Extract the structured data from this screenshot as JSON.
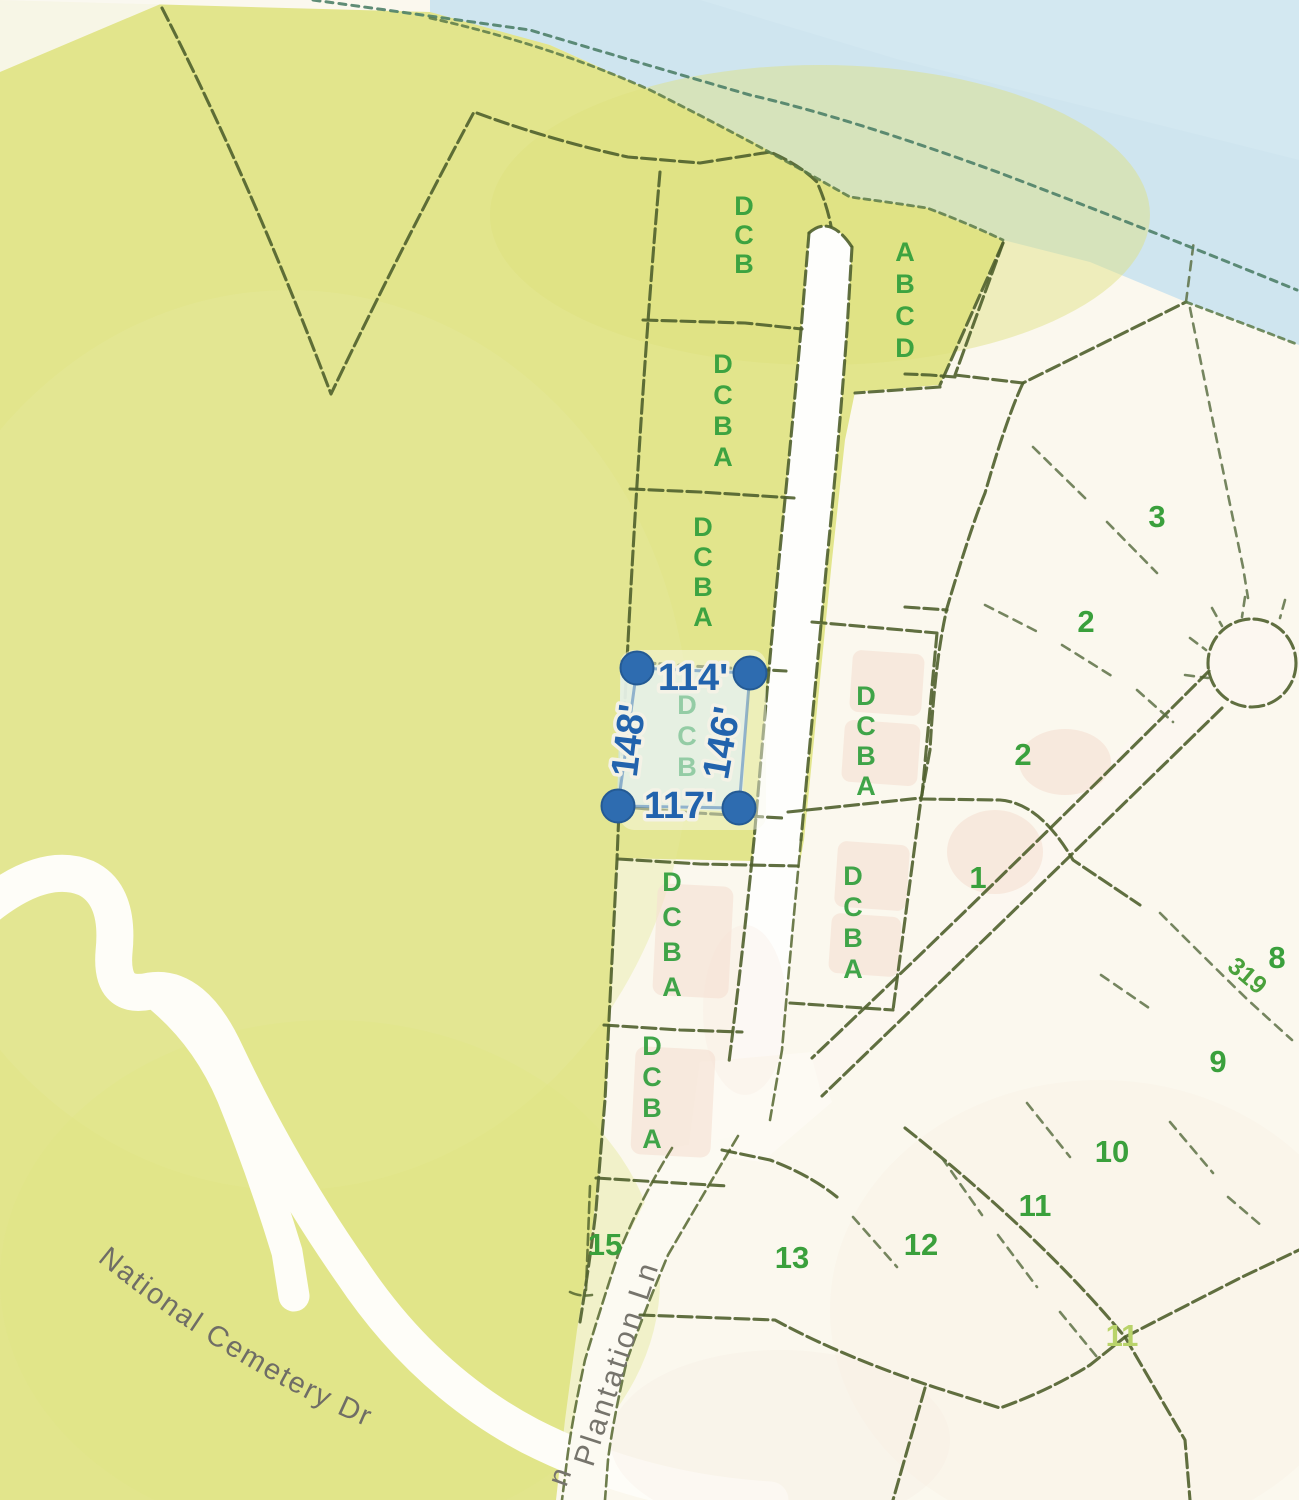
{
  "selection": {
    "letters": "DCB",
    "measurements": {
      "top": "114'",
      "bottom": "117'",
      "left": "148'",
      "right": "146'"
    }
  },
  "parcel_letter_groups": {
    "strip": [
      {
        "letters": "DCB"
      },
      {
        "letters": "DCBA"
      },
      {
        "letters": "DCBA"
      },
      {
        "letters": "DCBA"
      },
      {
        "letters": "DCBA"
      }
    ],
    "east": [
      {
        "letters": "DCBA"
      },
      {
        "letters": "DCBA"
      }
    ],
    "northeast": {
      "letters": "ABCD"
    }
  },
  "lots": [
    {
      "number": "3"
    },
    {
      "number": "2"
    },
    {
      "number": "2"
    },
    {
      "number": "1"
    },
    {
      "number": "8"
    },
    {
      "number": "9"
    },
    {
      "number": "10"
    },
    {
      "number": "11"
    },
    {
      "number": "12"
    },
    {
      "number": "13"
    },
    {
      "number": "15"
    },
    {
      "number": "11"
    }
  ],
  "roads": {
    "national_cemetery_dr": "National Cemetery Dr",
    "plantation_ln": "Plantation Ln",
    "plantation_fragment": "n",
    "route_319": "319"
  },
  "colors": {
    "water": "#cfe5ef",
    "land_yellow": "#e2e58c",
    "page_cream": "#fbf8ee",
    "boundary_green": "#4f5f2c",
    "lot_text_green": "#2f9e3b",
    "selection_blue": "#2263ad",
    "selection_marker_blue": "#2e6cb0",
    "selection_fill_teal": "#d2e7de",
    "road_label_gray": "#6f6d66",
    "building_pink": "#f6e0d2"
  }
}
